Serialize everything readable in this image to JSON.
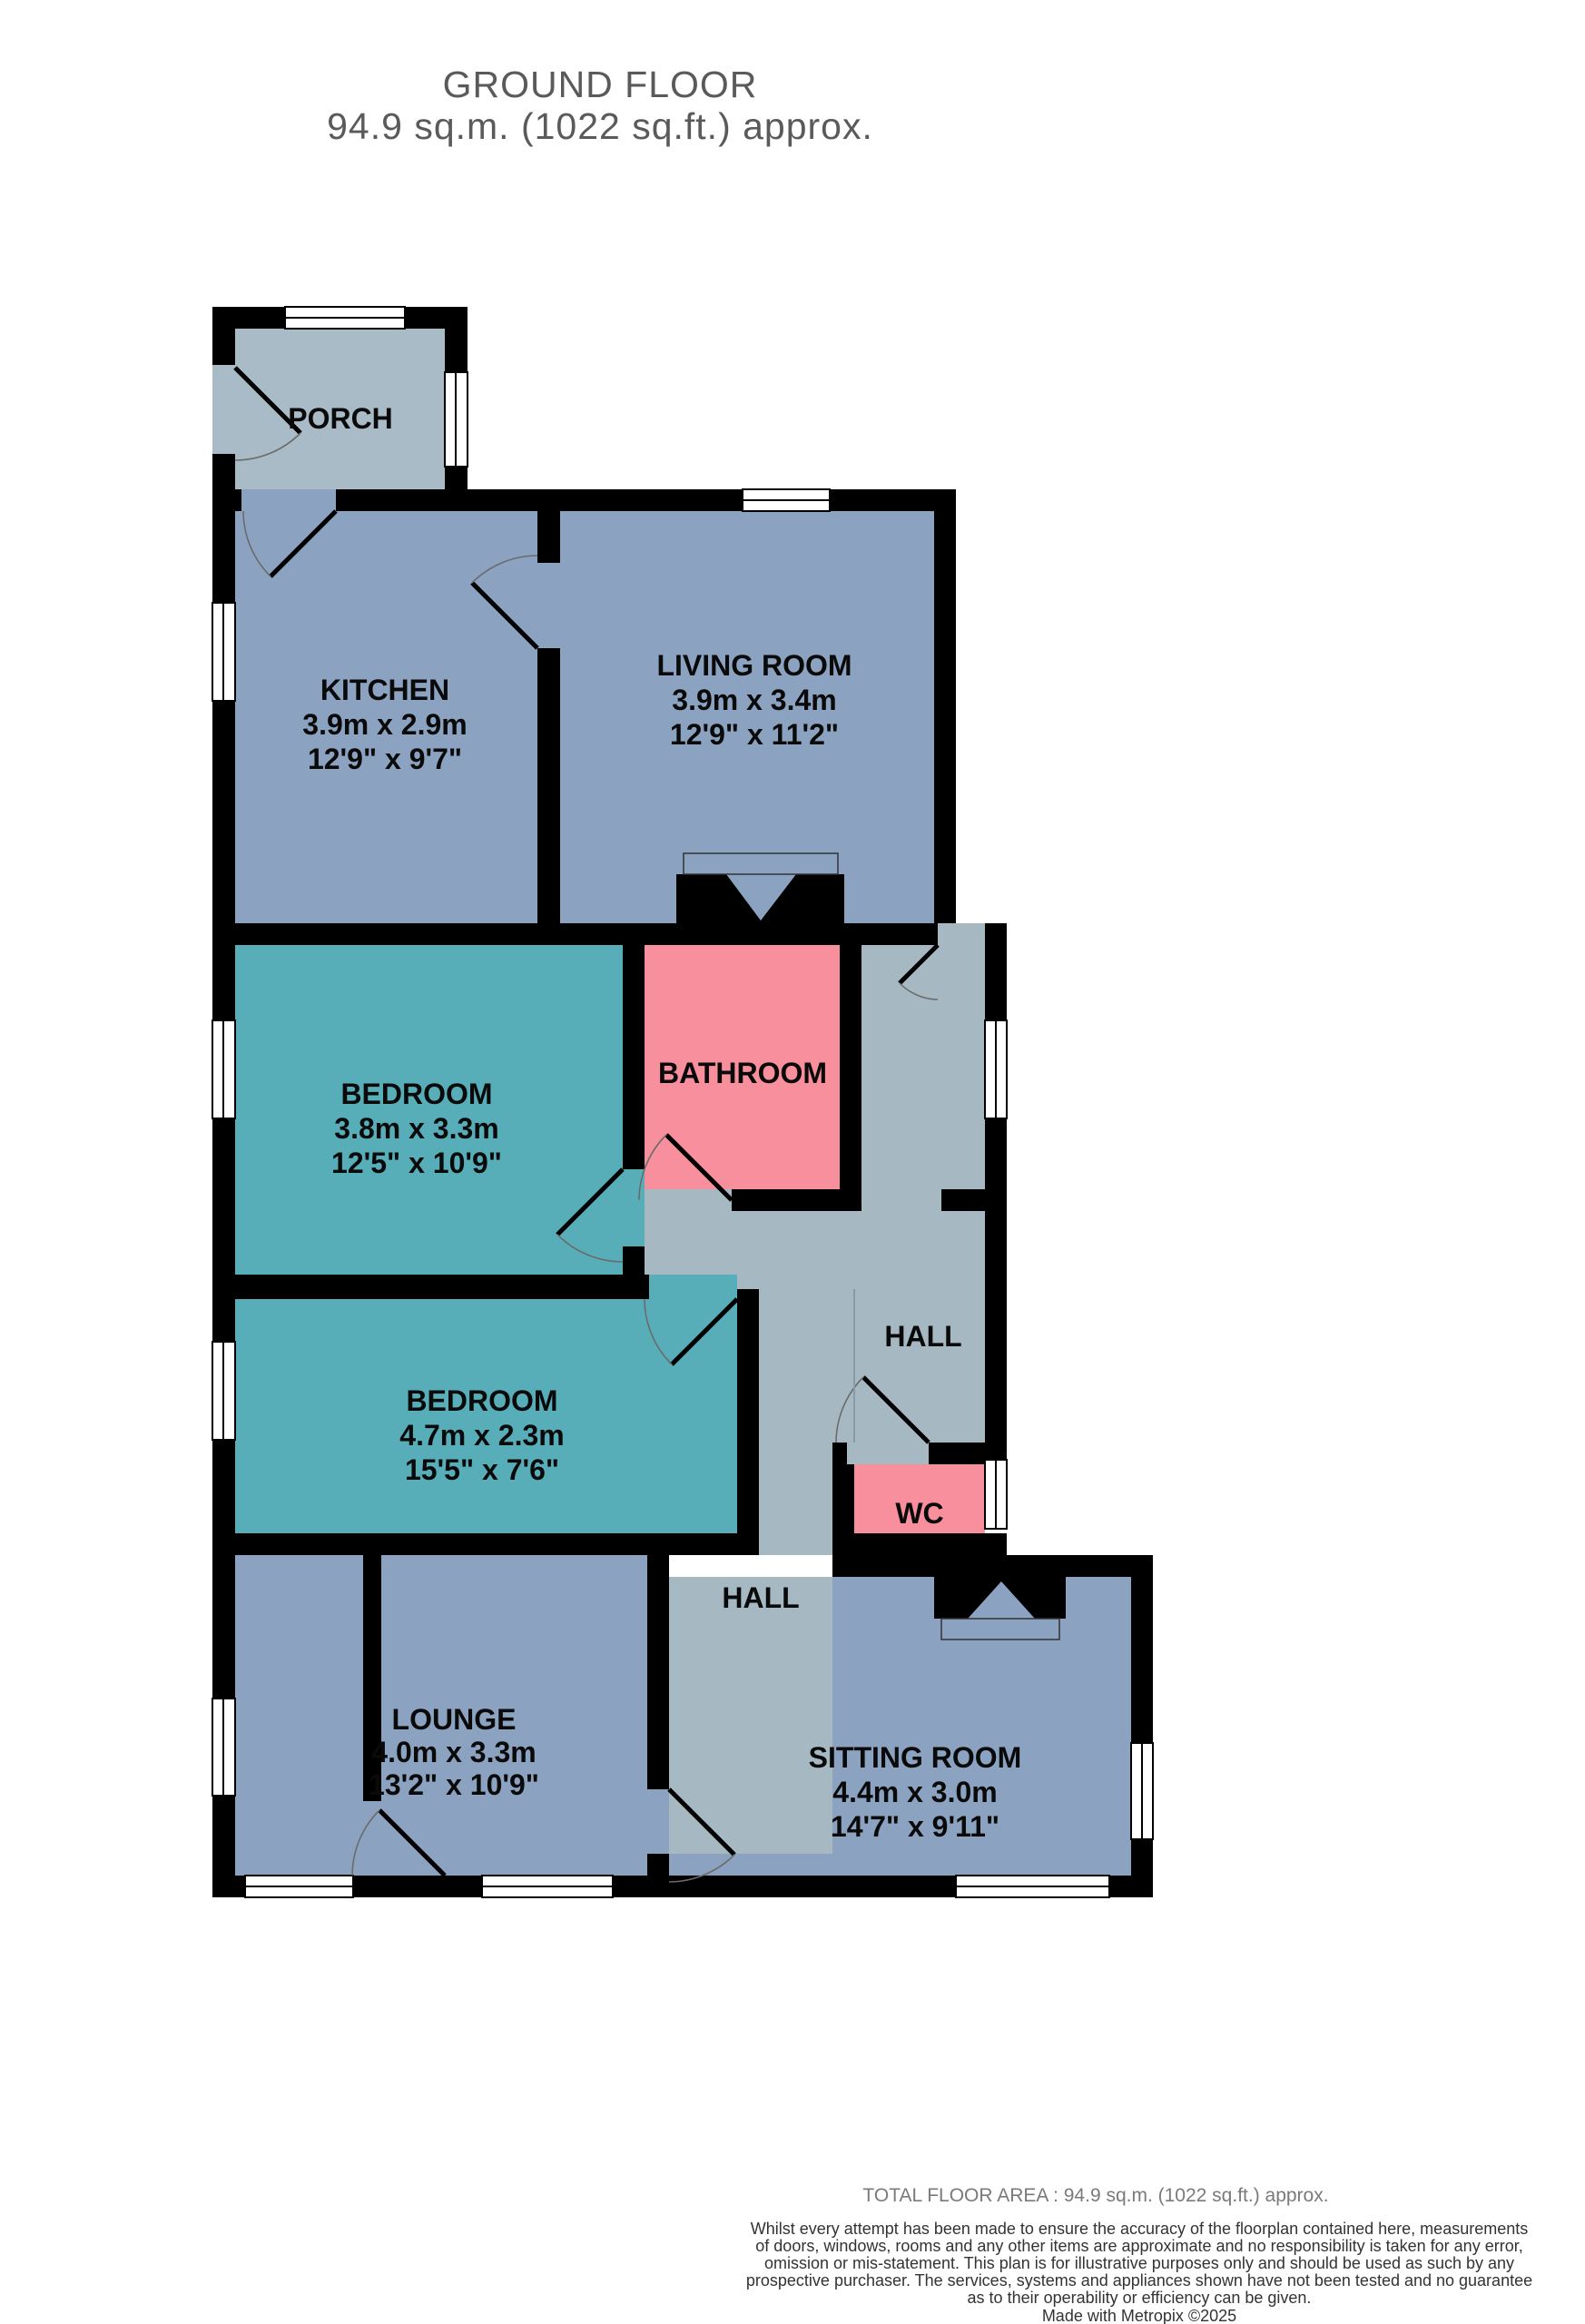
{
  "header": {
    "title": "GROUND FLOOR",
    "subtitle": "94.9 sq.m. (1022 sq.ft.) approx."
  },
  "rooms": {
    "porch": {
      "name": "PORCH"
    },
    "kitchen": {
      "name": "KITCHEN",
      "metric": "3.9m  x 2.9m",
      "imperial": "12'9\"  x 9'7\""
    },
    "living_room": {
      "name": "LIVING ROOM",
      "metric": "3.9m  x 3.4m",
      "imperial": "12'9\"  x 11'2\""
    },
    "bedroom_1": {
      "name": "BEDROOM",
      "metric": "3.8m  x 3.3m",
      "imperial": "12'5\"  x 10'9\""
    },
    "bathroom": {
      "name": "BATHROOM"
    },
    "hall_upper": {
      "name": "HALL"
    },
    "bedroom_2": {
      "name": "BEDROOM",
      "metric": "4.7m  x 2.3m",
      "imperial": "15'5\"  x 7'6\""
    },
    "wc": {
      "name": "WC"
    },
    "hall_lower": {
      "name": "HALL"
    },
    "lounge": {
      "name": "LOUNGE",
      "metric": "4.0m  x 3.3m",
      "imperial": "13'2\"  x 10'9\""
    },
    "sitting_room": {
      "name": "SITTING ROOM",
      "metric": "4.4m  x 3.0m",
      "imperial": "14'7\"  x 9'11\""
    }
  },
  "footer": {
    "total": "TOTAL FLOOR AREA : 94.9 sq.m. (1022 sq.ft.) approx.",
    "disclaimer_lines": [
      "Whilst every attempt has been made to ensure the accuracy of the floorplan contained here, measurements",
      "of doors, windows, rooms and any other items are approximate and no responsibility is taken for any error,",
      "omission or mis-statement. This plan is for illustrative purposes only and should be used as such by any",
      "prospective purchaser. The services, systems and appliances shown have not been tested and no guarantee",
      "as to their operability or efficiency can be given."
    ],
    "credit": "Made with Metropix ©2025"
  },
  "colors": {
    "room_blue": "#8ba3c0",
    "bedroom_teal": "#57aeb9",
    "wet_pink": "#f78f9c",
    "hall_gray": "#a6b8c2",
    "porch_gray": "#a9bbc6",
    "wall_black": "#000000",
    "title_gray": "#5a5a5a"
  }
}
